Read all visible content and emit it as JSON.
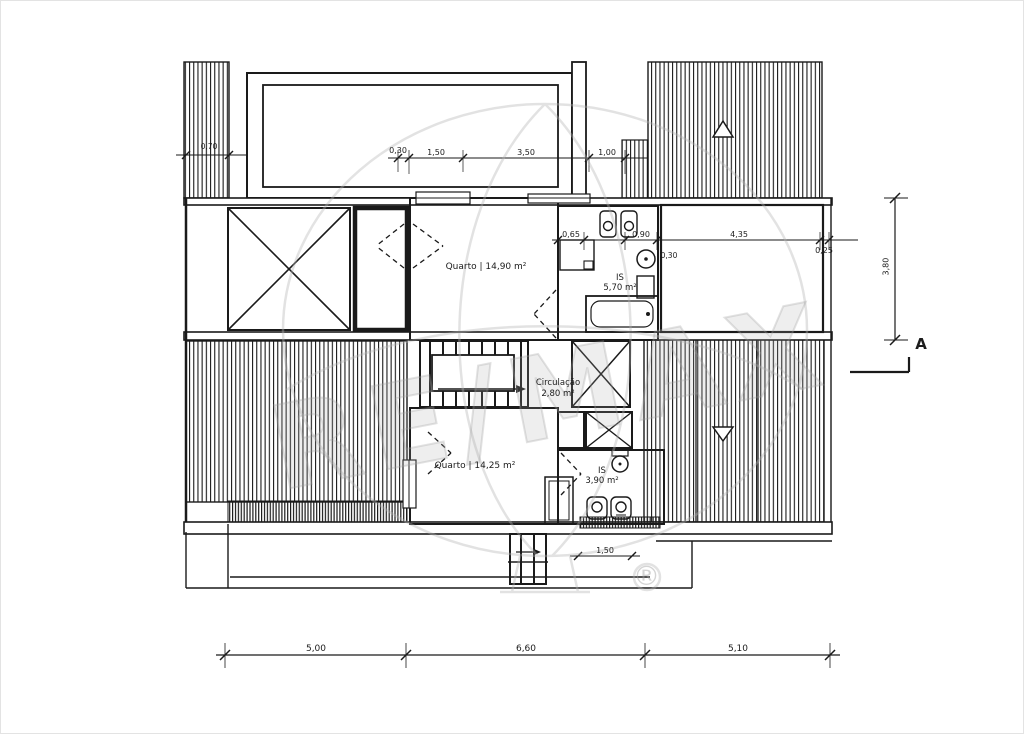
{
  "drawing": {
    "rooms": {
      "quarto1": "Quarto | 14,90 m²",
      "is1_name": "IS",
      "is1_area": "5,70 m²",
      "circulacao_name": "Circulação",
      "circulacao_area": "2,80 m²",
      "quarto2": "Quarto | 14,25 m²",
      "is2_name": "IS",
      "is2_area": "3,90 m²"
    },
    "dims": {
      "top": {
        "d1": "0,30",
        "d2": "1,50",
        "d3": "3,50",
        "d4": "1,00"
      },
      "left": "0,70",
      "mid": {
        "d1": "0,65",
        "d2": "0,90",
        "d3": "4,35",
        "d4": "0,25",
        "column": "0,30"
      },
      "stair": "1,50",
      "bottom": {
        "d1": "5,00",
        "d2": "6,60",
        "d3": "5,10"
      },
      "right_vertical": "3,80"
    },
    "section_marker": "A",
    "watermark": {
      "text": "RE/MAX",
      "registered": "®"
    }
  },
  "colors": {
    "line": "#1a1a1a",
    "watermark": "#b5b5b5",
    "background": "#ffffff"
  }
}
